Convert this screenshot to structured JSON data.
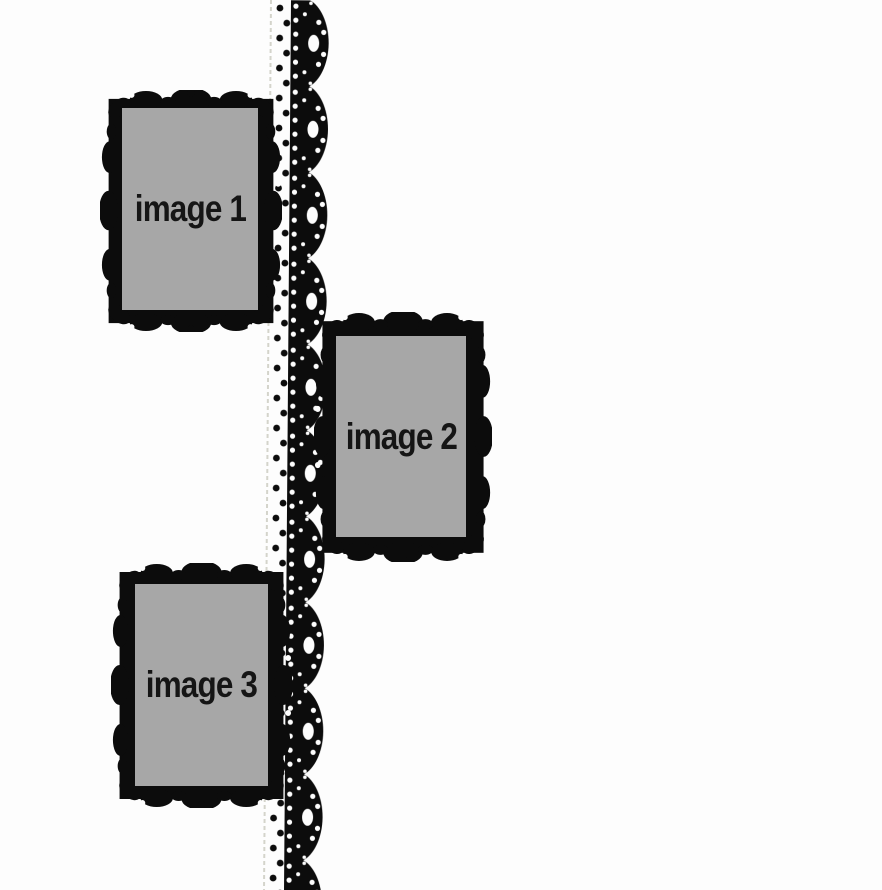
{
  "frames": [
    {
      "label": "image 1"
    },
    {
      "label": "image 2"
    },
    {
      "label": "image 3"
    }
  ],
  "colors": {
    "background": "#fdfdfd",
    "ink": "#0c0c0c",
    "placeholder": "#a7a7a7",
    "stitch": "#d4d4cb",
    "text": "#151515"
  },
  "decor": {
    "lace_ribbon": "black scalloped lace trim, full page height",
    "stitch_strip": "white strip with zigzag black polka-dot stitching",
    "frame_style": "ornate baroque black frame silhouette"
  }
}
